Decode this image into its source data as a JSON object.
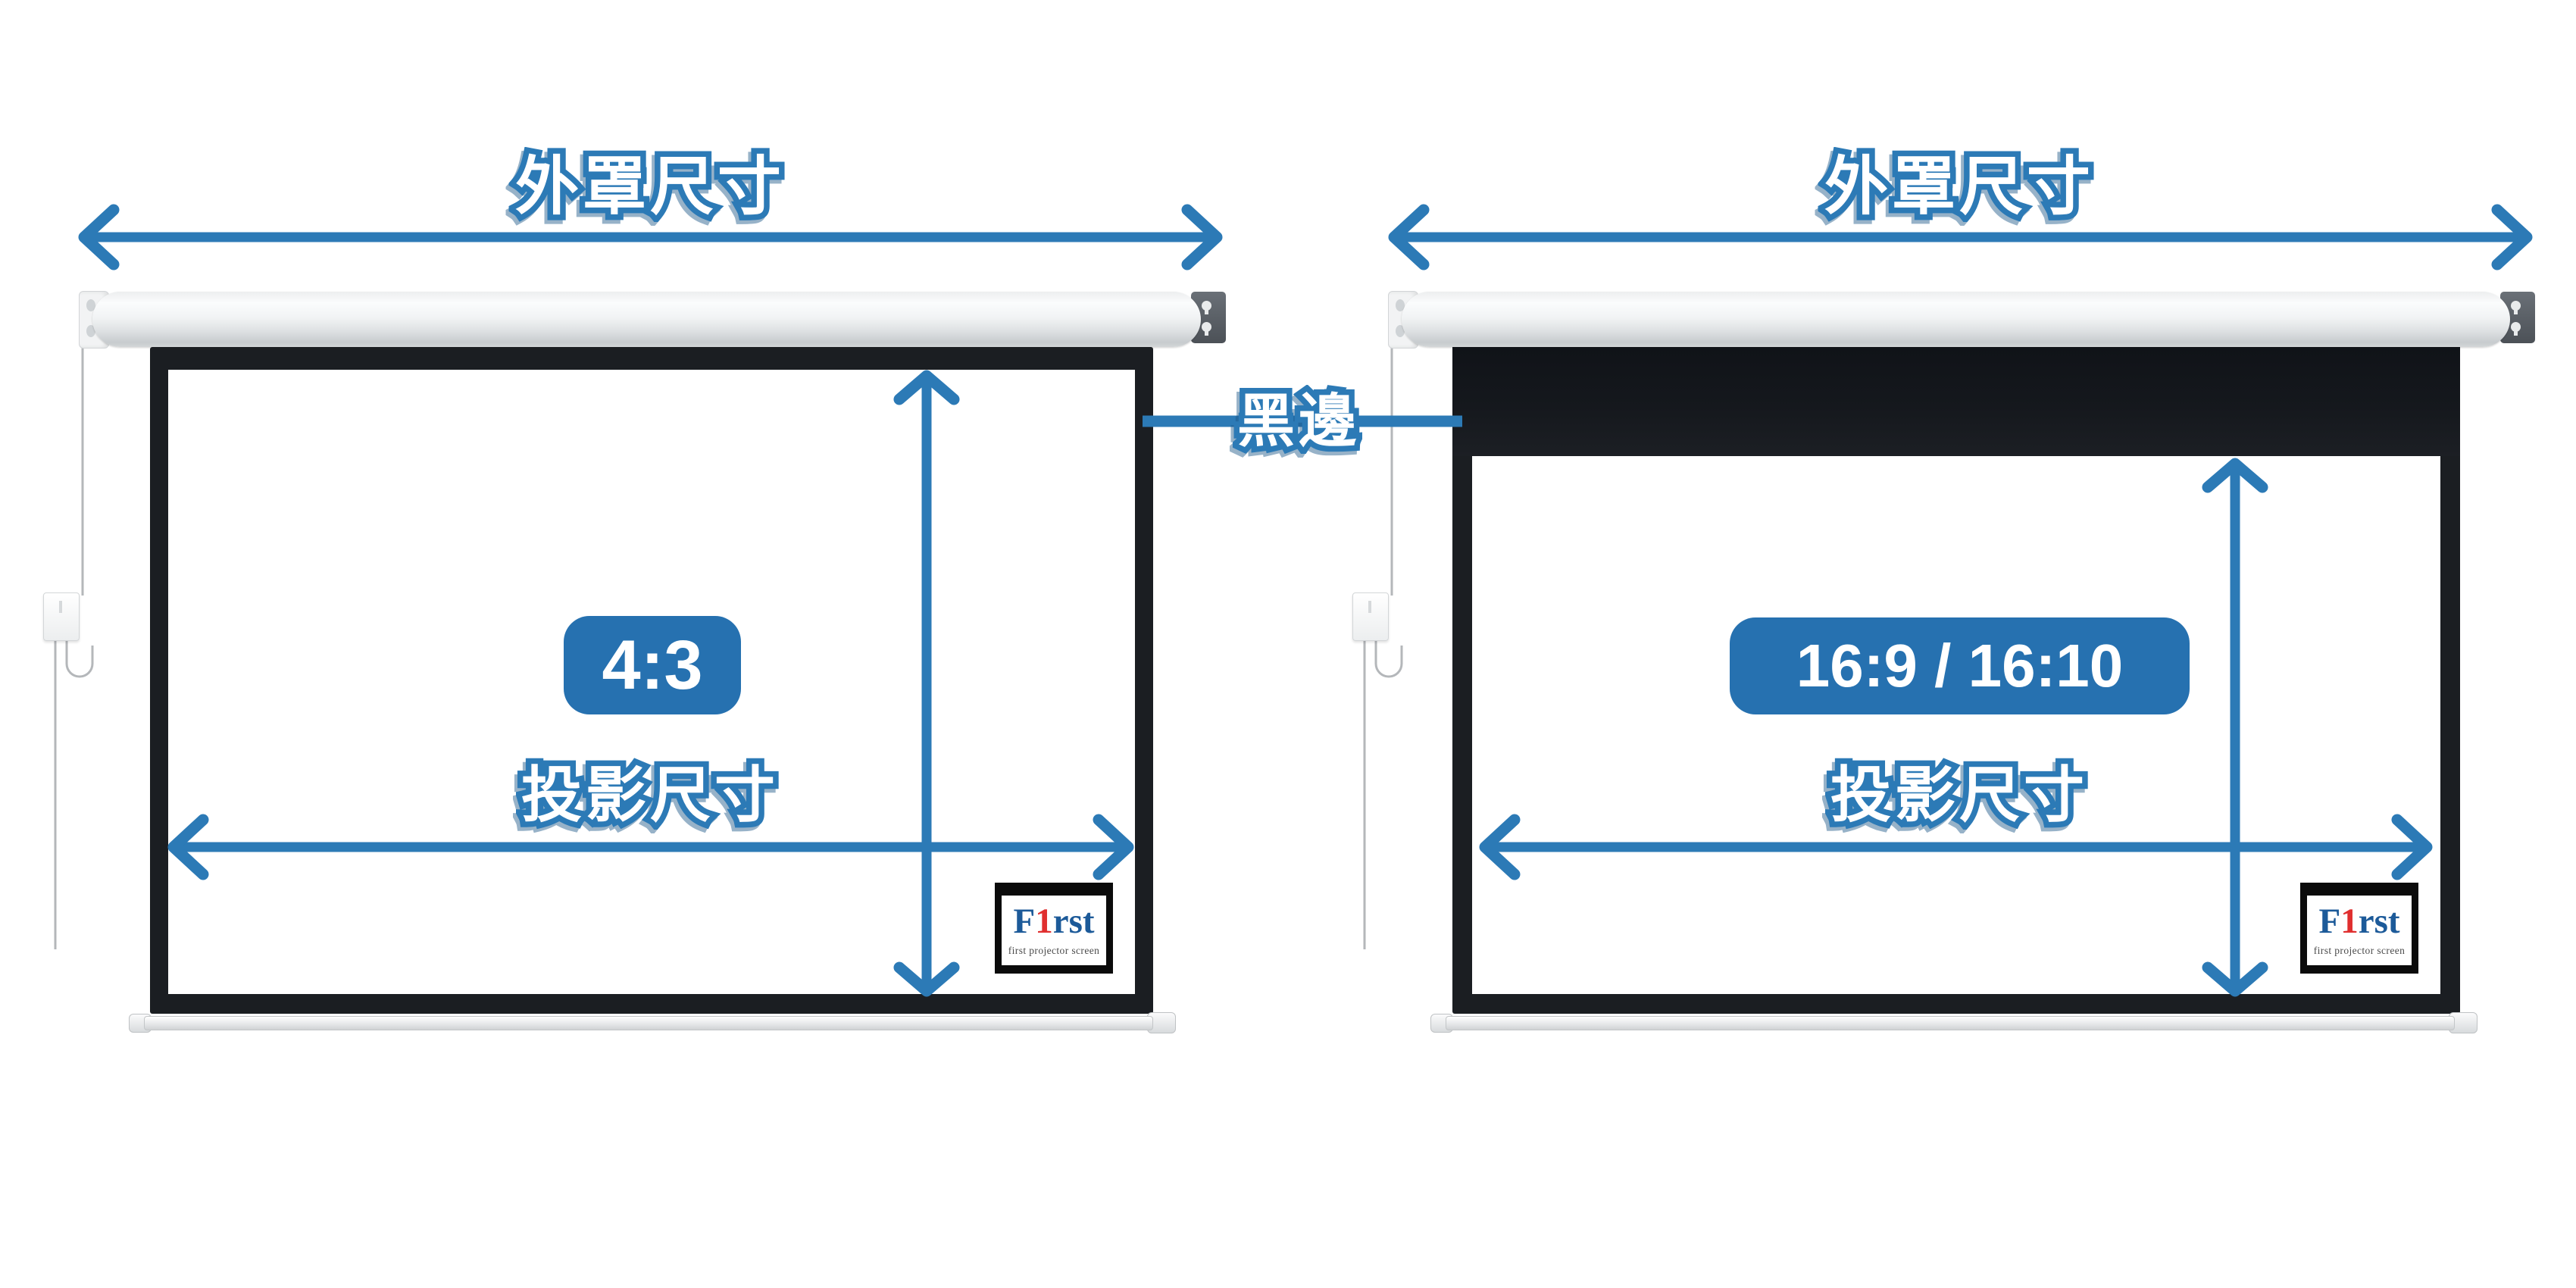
{
  "black_border_label": "黑邊",
  "panels": [
    {
      "name": "4:3 screen",
      "housing_dimension_label": "外罩尺寸",
      "aspect_ratio_badge": "4:3",
      "projection_dimension_label": "投影尺寸",
      "logo": {
        "letter_f": "F",
        "letter_one": "1",
        "letters_rst": "rst",
        "tagline": "first projector screen"
      }
    },
    {
      "name": "16:9 / 16:10 screen",
      "housing_dimension_label": "外罩尺寸",
      "aspect_ratio_badge": "16:9 / 16:10",
      "projection_dimension_label": "投影尺寸",
      "logo": {
        "letter_f": "F",
        "letter_one": "1",
        "letters_rst": "rst",
        "tagline": "first projector screen"
      }
    }
  ],
  "colors": {
    "accent_blue": "#2c7ab6",
    "badge_blue": "#2671b0",
    "frame_black": "#1b1e22",
    "logo_blue": "#1c5a99",
    "logo_red": "#e02f2f",
    "logo_tagline_gray": "#4a4a4a"
  }
}
